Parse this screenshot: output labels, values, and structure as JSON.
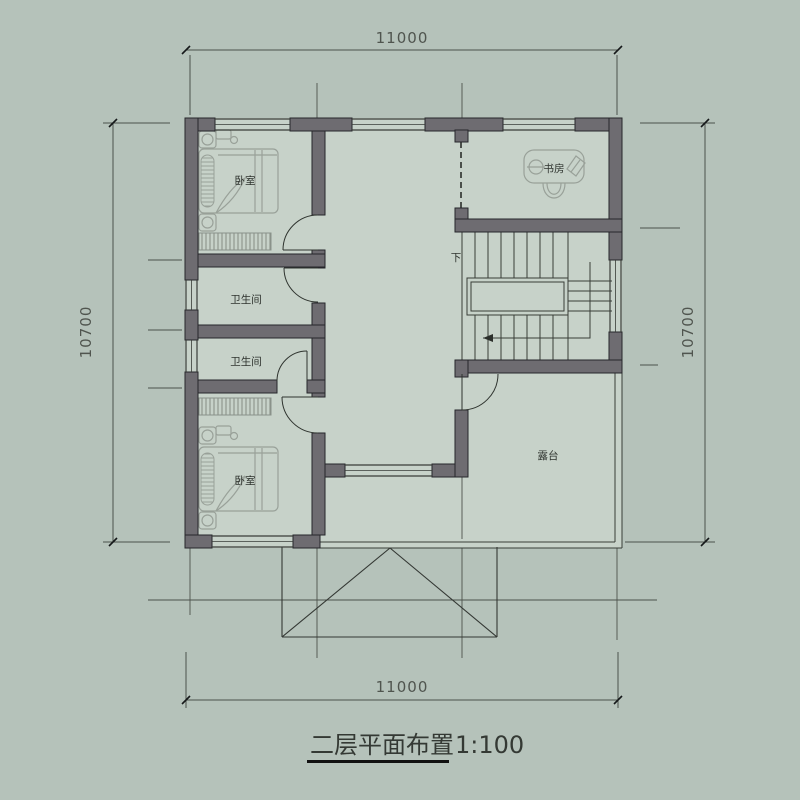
{
  "drawing": {
    "title": "二层平面布置",
    "scale": "1:100"
  },
  "dimensions": {
    "top": "11000",
    "bottom": "11000",
    "left": "10700",
    "right": "10700"
  },
  "rooms": {
    "bedroom_top": "卧室",
    "bedroom_bottom": "卧室",
    "bathroom_upper": "卫生间",
    "bathroom_lower": "卫生间",
    "study": "书房",
    "terrace": "露台",
    "stair_direction": "下"
  },
  "colors": {
    "bg-outer": "#b5c2ba",
    "bg-inner": "#c7d2c9",
    "wall": "#6e6c71",
    "wall-edge": "#26262b",
    "line": "#4c524c",
    "furn": "#99a199",
    "text": "#2e332e",
    "dim-text": "#50554f"
  }
}
